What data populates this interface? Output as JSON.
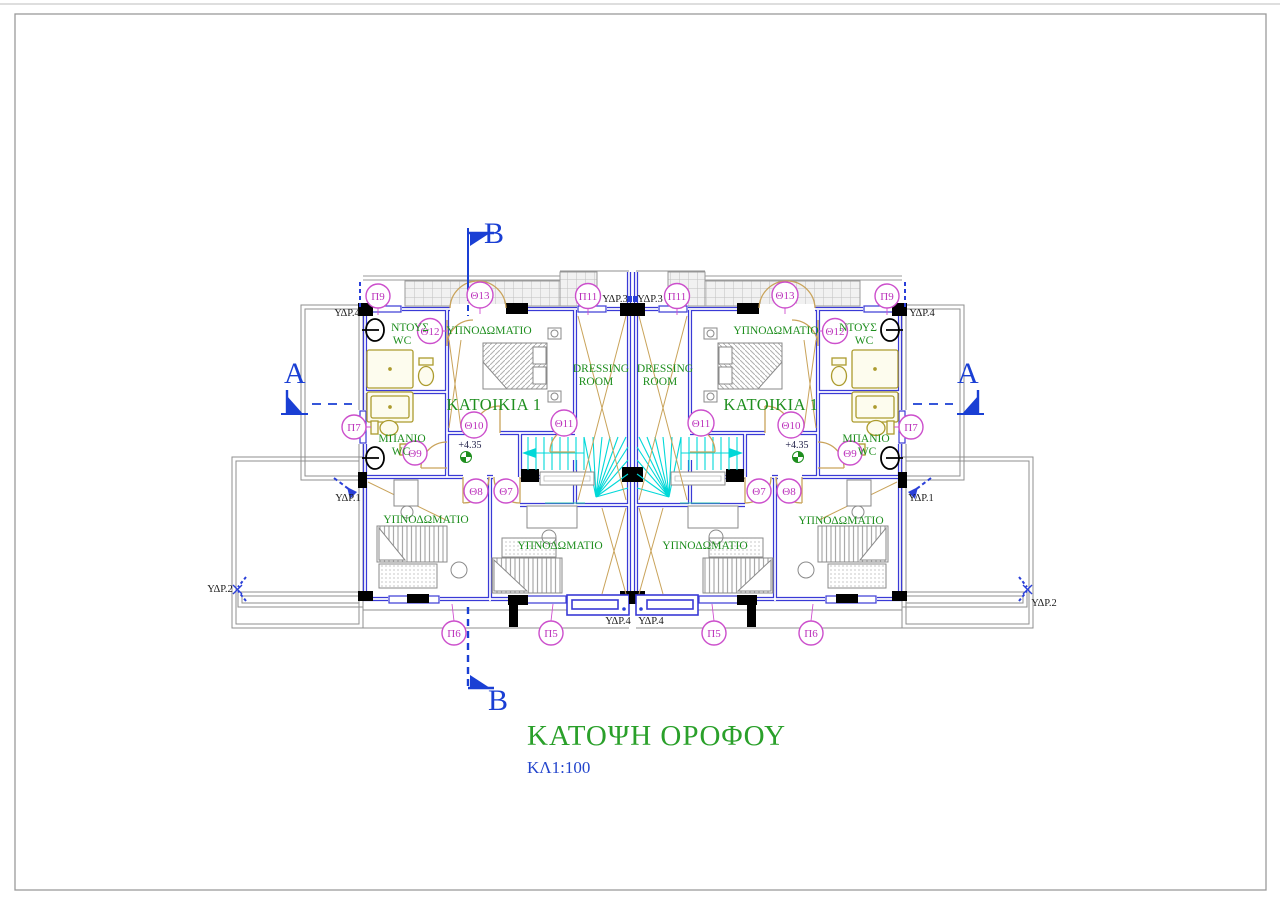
{
  "title": {
    "text": "ΚΑΤΟΨΗ ΟΡΟΦΟΥ",
    "scale": "ΚΛ1:100"
  },
  "sections": {
    "a": "A",
    "b": "B"
  },
  "unit": {
    "name": "ΚΑΤΟΙΚΙΑ 1"
  },
  "rooms": {
    "bedroom": "ΥΠΝΟΔΩΜΑΤΙΟ",
    "dressing1": "DRESSING",
    "dressing2": "ROOM",
    "shower1": "ΝΤΟΥΣ",
    "shower2": "WC",
    "bath1": "ΜΠΑΝΙΟ",
    "bath2": "WC"
  },
  "plumbing": {
    "ydr1": "ΥΔΡ.1",
    "ydr2": "ΥΔΡ.2",
    "ydr3": "ΥΔΡ.3",
    "ydr4": "ΥΔΡ.4"
  },
  "level": {
    "value": "+4.35"
  },
  "tags": {
    "p5": "Π5",
    "p6": "Π6",
    "p7": "Π7",
    "p9": "Π9",
    "p11": "Π11",
    "th7": "Θ7",
    "th8": "Θ8",
    "th9": "Θ9",
    "th10": "Θ10",
    "th11": "Θ11",
    "th12": "Θ12",
    "th13": "Θ13"
  },
  "colors": {
    "wall_blue": "#3a3ad6",
    "section_blue": "#1a3fd4",
    "stair_cyan": "#00d8d8",
    "tag_magenta": "#cc4fcc",
    "label_green": "#1e8e1e",
    "title_green": "#2aa02a",
    "fixture_olive": "#ac9b2e",
    "door_tan": "#c9a35a",
    "terrace_gray": "#8f8f8f"
  }
}
